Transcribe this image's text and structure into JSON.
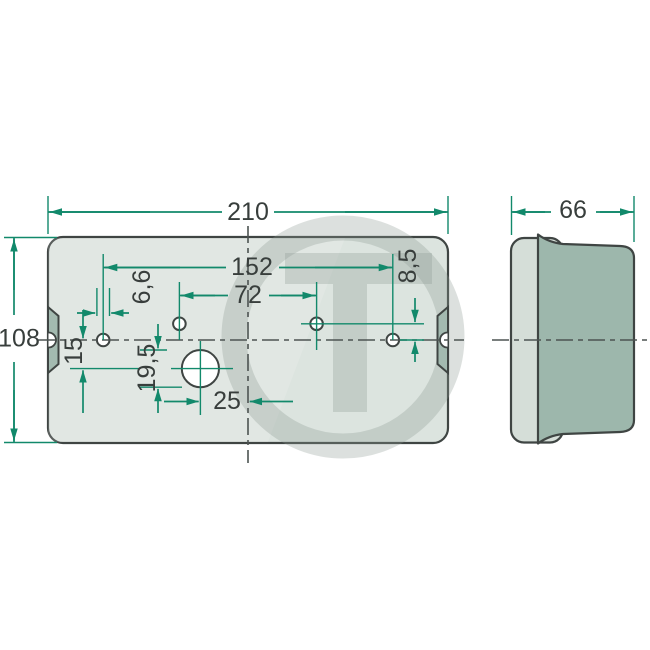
{
  "meta": {
    "description": "Technical dimension drawing of a rear lamp base plate, front view and side view, measurements in mm",
    "background": "#ffffff"
  },
  "palette": {
    "dimension_line": "#12896b",
    "part_outline": "#3f4543",
    "plate_fill": "#dce4df",
    "side_flange_fill": "#d5ded8",
    "side_body_fill": "#9db7ac",
    "edge_tab_fill": "#a3bab0",
    "label_text": "#383e3c",
    "watermark_gray": "rgba(140,152,147,0.30)"
  },
  "front_view": {
    "dim_width": "210",
    "dim_height": "108",
    "dim_outer_hole_span": "152",
    "dim_inner_hole_span": "72",
    "dim_small_hole_diameter": "6,6",
    "dim_top_hole_row_offset": "8,5",
    "dim_large_hole_vertical_offset": "15",
    "dim_large_hole_diameter": "19,5",
    "dim_large_hole_horizontal_offset": "25"
  },
  "side_view": {
    "dim_depth": "66"
  },
  "watermark": {
    "letter": "T"
  }
}
